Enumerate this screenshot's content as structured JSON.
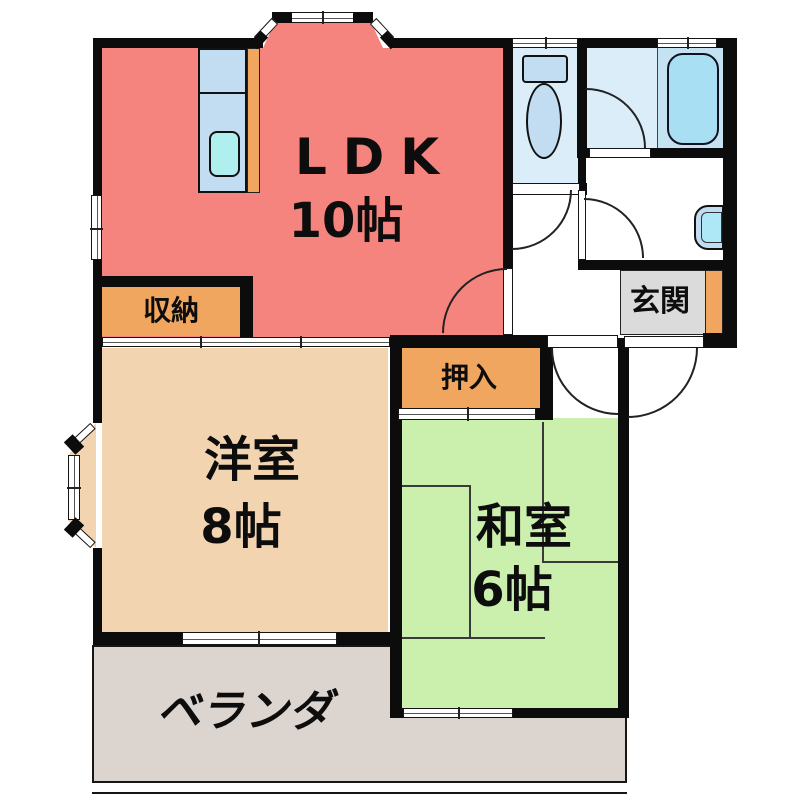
{
  "colors": {
    "wall": "#0c0c0c",
    "ldk_red": "#F5847E",
    "western_tan": "#F2D4B0",
    "japanese_green": "#CBEFAD",
    "closet_orange": "#F0A65F",
    "entrance_gray": "#DBDBDB",
    "veranda_gray": "#DCD4CE",
    "wet_blue": "#DBEDF9",
    "bath_zone_blue": "#C4E2F2",
    "tub_blue": "#A9DFF2",
    "fixture_blue": "#C2DCF2",
    "sink_cyan": "#AFF0EE",
    "basin_cyan": "#AEE7F6"
  },
  "rooms": {
    "ldk": {
      "label": "LDK",
      "size": "10帖"
    },
    "western": {
      "label": "洋室",
      "size": "8帖"
    },
    "japanese": {
      "label": "和室",
      "size": "6帖"
    },
    "storage": {
      "label": "収納"
    },
    "oshiire": {
      "label": "押入"
    },
    "entrance": {
      "label": "玄関"
    },
    "veranda": {
      "label": "ベランダ"
    }
  },
  "fixtures": [
    "kitchen-counter",
    "kitchen-sink",
    "toilet",
    "bathtub",
    "washbasin"
  ]
}
